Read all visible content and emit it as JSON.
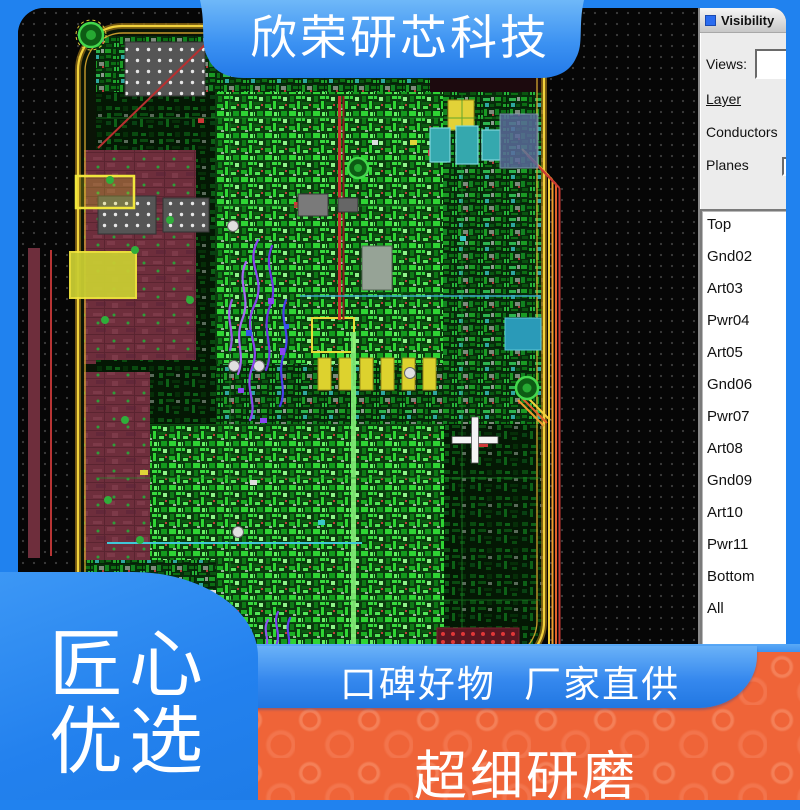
{
  "branding": {
    "company_banner": "欣荣研芯科技",
    "badge_line1": "匠心",
    "badge_line2": "优选",
    "ribbon_text": "口碑好物 厂家直供",
    "bottom_slogan": "超细研磨"
  },
  "visibility_panel": {
    "title": "Visibility",
    "views_label": "Views:",
    "views_value": "",
    "layer_link": "Layer",
    "conductors_label": "Conductors",
    "planes_label": "Planes",
    "layers": [
      "Top",
      "Gnd02",
      "Art03",
      "Pwr04",
      "Art05",
      "Gnd06",
      "Pwr07",
      "Art08",
      "Gnd09",
      "Art10",
      "Pwr11",
      "Bottom",
      "All"
    ]
  },
  "colors": {
    "frame_blue": "#2082ef",
    "banner_blue_light": "#66b3f7",
    "accent_orange": "#ef6438",
    "board_outline_yellow": "#f2d23c",
    "trace_green": "#2fd434",
    "plane_maroon": "#6e2e3c",
    "highlight_purple": "#8a45f2"
  }
}
